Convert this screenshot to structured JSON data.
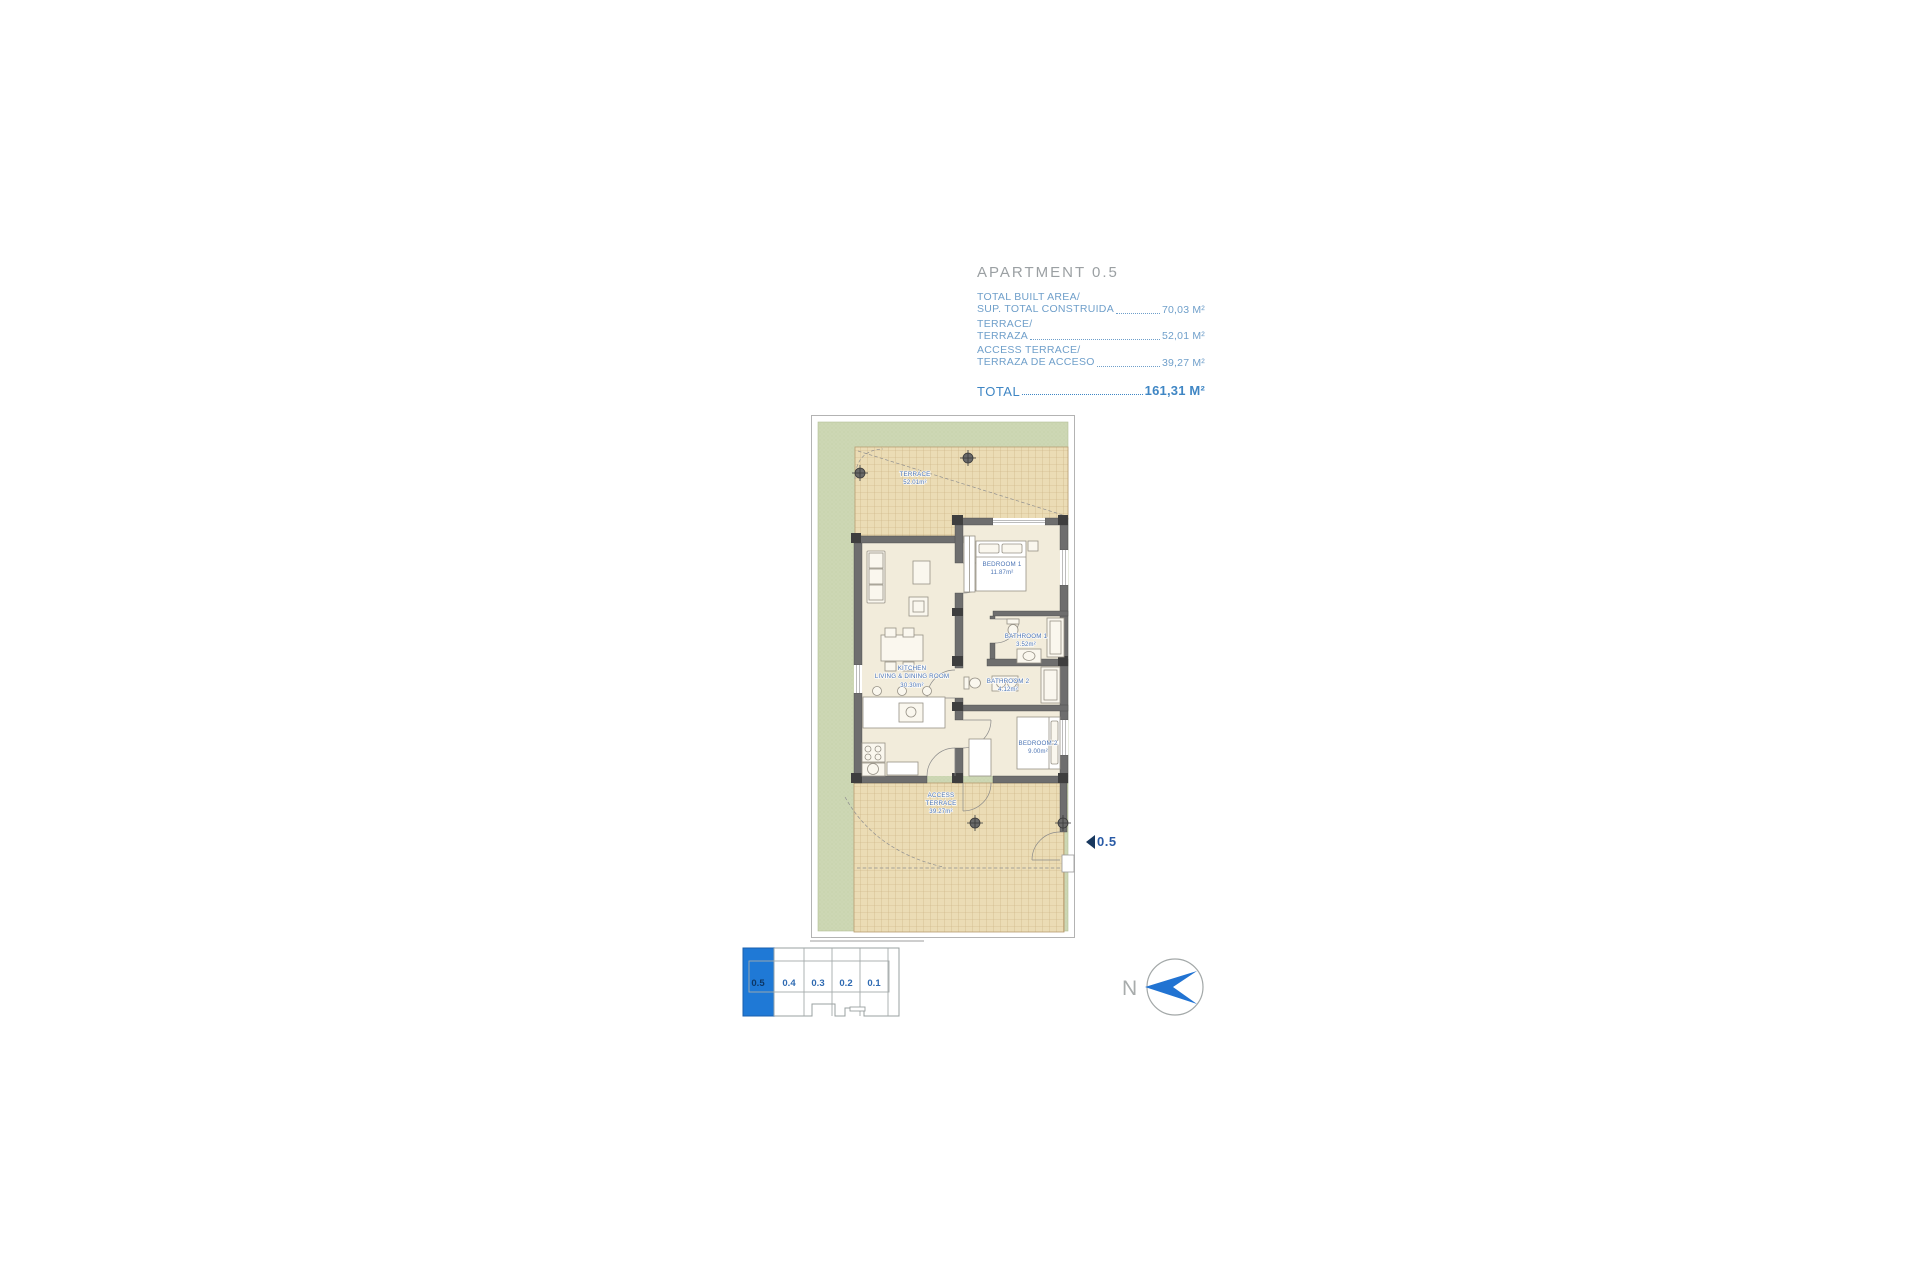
{
  "header": {
    "title": "APARTMENT 0.5",
    "entries": [
      {
        "label1": "TOTAL BUILT AREA/",
        "label2": "SUP. TOTAL CONSTRUIDA",
        "value": "70,03 M²"
      },
      {
        "label1": "TERRACE/",
        "label2": "TERRAZA",
        "value": "52,01 M²"
      },
      {
        "label1": "ACCESS TERRACE/",
        "label2": "TERRAZA DE ACCESO",
        "value": "39,27 M²"
      }
    ],
    "total_label": "TOTAL",
    "total_value": "161,31 M²"
  },
  "plan": {
    "terrace": {
      "label": "TERRACE",
      "area": "52.01m²"
    },
    "bedroom1": {
      "label": "BEDROOM  1",
      "area": "11.87m²"
    },
    "bathroom1": {
      "label": "BATHROOM  1",
      "area": "3.52m²"
    },
    "kitchen": {
      "line1": "KITCHEN",
      "line2": "LIVING  &  DINING  ROOM",
      "area": "30.30m²"
    },
    "bathroom2": {
      "label": "BATHROOM  2",
      "area": "4.12m²"
    },
    "bedroom2": {
      "label": "BEDROOM  2",
      "area": "9.00m²"
    },
    "accessTerrace": {
      "line1": "ACCESS",
      "line2": "TERRACE",
      "area": "39.27m²"
    },
    "unit_marker": "0.5"
  },
  "locator": {
    "units": [
      "0.5",
      "0.4",
      "0.3",
      "0.2",
      "0.1"
    ],
    "highlighted": "0.5"
  },
  "compass": {
    "label": "N"
  },
  "colors": {
    "accent_blue": "#3f86c4",
    "label_blue": "#4b74b4",
    "title_gray": "#9ba0a3",
    "garden_green": "#cdd7b4",
    "tile_tan": "#ebdcb5",
    "tile_grid": "#c9ad7e",
    "wall_gray": "#6e6e6e",
    "interior_cream": "#f2ecdb",
    "locator_blue": "#1f79d6",
    "compass_blue": "#2173d2"
  }
}
